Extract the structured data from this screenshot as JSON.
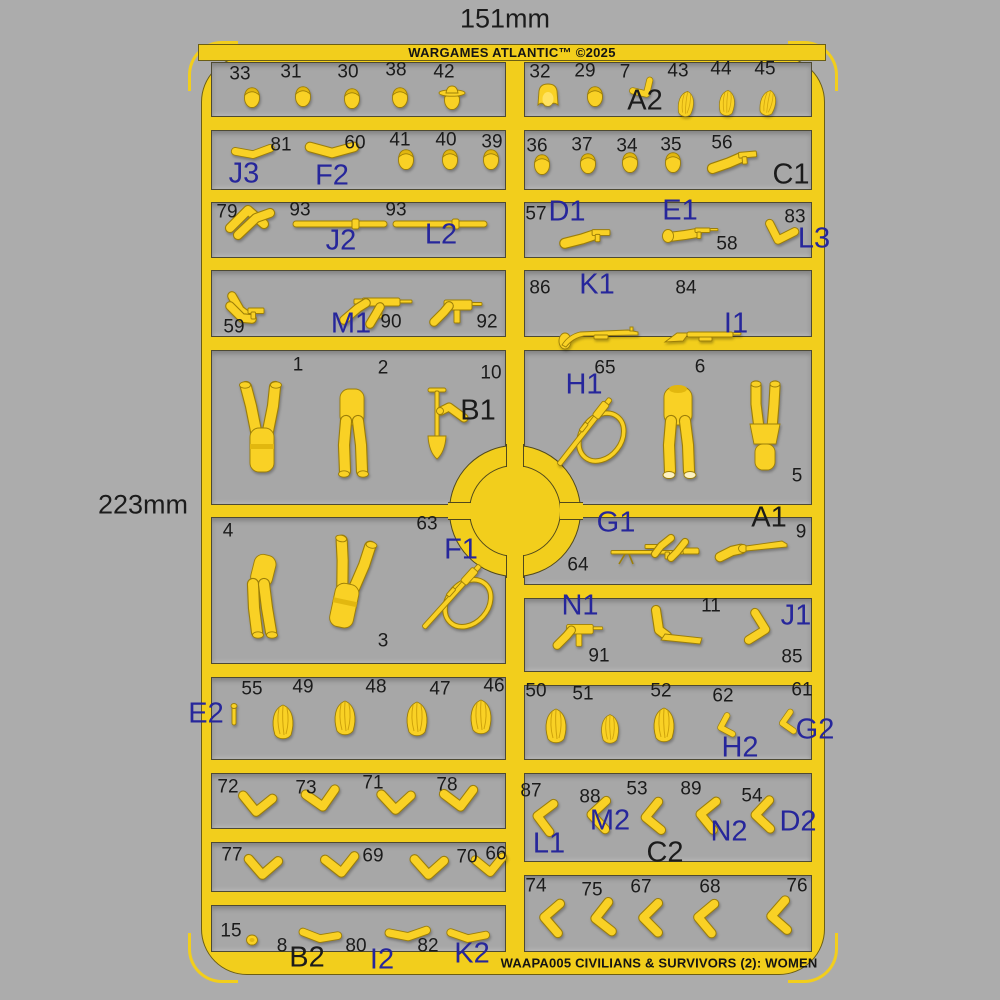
{
  "annotations": {
    "width_label": "151mm",
    "height_label": "223mm",
    "top_title": "WARGAMES ATLANTIC™ ©2025",
    "bottom_title": "WAAPA005 CIVILIANS & SURVIVORS (2): WOMEN"
  },
  "colors": {
    "background": "#acacac",
    "sprue_yellow": "#f2ce1c",
    "compartment_gray": "#a7a7a7",
    "part_yellow": "#f9d125",
    "part_shade": "#9c7e08",
    "code_blue": "#26269b",
    "ink_black": "#1b1b1b"
  },
  "labels": [
    [
      "33",
      "n",
      240,
      74
    ],
    [
      "31",
      "n",
      291,
      72
    ],
    [
      "30",
      "n",
      348,
      72
    ],
    [
      "38",
      "n",
      396,
      70
    ],
    [
      "42",
      "n",
      444,
      72
    ],
    [
      "32",
      "n",
      540,
      72
    ],
    [
      "29",
      "n",
      585,
      71
    ],
    [
      "7",
      "n",
      625,
      72
    ],
    [
      "43",
      "n",
      678,
      71
    ],
    [
      "44",
      "n",
      721,
      69
    ],
    [
      "45",
      "n",
      765,
      69
    ],
    [
      "A2",
      "ck",
      645,
      101
    ],
    [
      "81",
      "n",
      281,
      145
    ],
    [
      "60",
      "n",
      355,
      143
    ],
    [
      "41",
      "n",
      400,
      140
    ],
    [
      "40",
      "n",
      446,
      140
    ],
    [
      "39",
      "n",
      492,
      142
    ],
    [
      "J3",
      "cb",
      244,
      174
    ],
    [
      "F2",
      "cb",
      332,
      176
    ],
    [
      "36",
      "n",
      537,
      146
    ],
    [
      "37",
      "n",
      582,
      145
    ],
    [
      "34",
      "n",
      627,
      146
    ],
    [
      "35",
      "n",
      671,
      145
    ],
    [
      "56",
      "n",
      722,
      143
    ],
    [
      "C1",
      "ck",
      791,
      175
    ],
    [
      "79",
      "n",
      227,
      212
    ],
    [
      "93",
      "n",
      300,
      210
    ],
    [
      "93",
      "n",
      396,
      210
    ],
    [
      "J2",
      "cb",
      341,
      241
    ],
    [
      "L2",
      "cb",
      441,
      235
    ],
    [
      "57",
      "n",
      536,
      214
    ],
    [
      "58",
      "n",
      727,
      244
    ],
    [
      "83",
      "n",
      795,
      217
    ],
    [
      "D1",
      "cb",
      567,
      212
    ],
    [
      "E1",
      "cb",
      680,
      211
    ],
    [
      "L3",
      "cb",
      814,
      239
    ],
    [
      "59",
      "n",
      234,
      327
    ],
    [
      "90",
      "n",
      391,
      322
    ],
    [
      "92",
      "n",
      487,
      322
    ],
    [
      "M1",
      "cb",
      351,
      324
    ],
    [
      "86",
      "n",
      540,
      288
    ],
    [
      "84",
      "n",
      686,
      288
    ],
    [
      "K1",
      "cb",
      597,
      285
    ],
    [
      "I1",
      "cb",
      736,
      324
    ],
    [
      "1",
      "n",
      298,
      365
    ],
    [
      "2",
      "n",
      383,
      368
    ],
    [
      "10",
      "n",
      491,
      373
    ],
    [
      "B1",
      "ck",
      478,
      411
    ],
    [
      "65",
      "n",
      605,
      368
    ],
    [
      "6",
      "n",
      700,
      367
    ],
    [
      "5",
      "n",
      797,
      476
    ],
    [
      "H1",
      "cb",
      584,
      385
    ],
    [
      "4",
      "n",
      228,
      531
    ],
    [
      "63",
      "n",
      427,
      524
    ],
    [
      "3",
      "n",
      383,
      641
    ],
    [
      "F1",
      "cb",
      461,
      550
    ],
    [
      "64",
      "n",
      578,
      565
    ],
    [
      "9",
      "n",
      801,
      532
    ],
    [
      "G1",
      "cb",
      616,
      523
    ],
    [
      "A1",
      "ck",
      769,
      518
    ],
    [
      "91",
      "n",
      599,
      656
    ],
    [
      "11",
      "n",
      711,
      606
    ],
    [
      "85",
      "n",
      792,
      657
    ],
    [
      "N1",
      "cb",
      580,
      606
    ],
    [
      "J1",
      "cb",
      796,
      616
    ],
    [
      "55",
      "n",
      252,
      689
    ],
    [
      "49",
      "n",
      303,
      687
    ],
    [
      "48",
      "n",
      376,
      687
    ],
    [
      "47",
      "n",
      440,
      689
    ],
    [
      "46",
      "n",
      494,
      686
    ],
    [
      "E2",
      "cb",
      206,
      714
    ],
    [
      "50",
      "n",
      536,
      691
    ],
    [
      "51",
      "n",
      583,
      694
    ],
    [
      "52",
      "n",
      661,
      691
    ],
    [
      "62",
      "n",
      723,
      696
    ],
    [
      "61",
      "n",
      802,
      690
    ],
    [
      "H2",
      "cb",
      740,
      748
    ],
    [
      "G2",
      "cb",
      815,
      730
    ],
    [
      "72",
      "n",
      228,
      787
    ],
    [
      "73",
      "n",
      306,
      788
    ],
    [
      "71",
      "n",
      373,
      783
    ],
    [
      "78",
      "n",
      447,
      785
    ],
    [
      "87",
      "n",
      531,
      791
    ],
    [
      "88",
      "n",
      590,
      797
    ],
    [
      "53",
      "n",
      637,
      789
    ],
    [
      "89",
      "n",
      691,
      789
    ],
    [
      "54",
      "n",
      752,
      796
    ],
    [
      "L1",
      "cb",
      549,
      844
    ],
    [
      "M2",
      "cb",
      610,
      821
    ],
    [
      "C2",
      "ck",
      665,
      853
    ],
    [
      "N2",
      "cb",
      729,
      832
    ],
    [
      "D2",
      "cb",
      798,
      822
    ],
    [
      "77",
      "n",
      232,
      855
    ],
    [
      "69",
      "n",
      373,
      856
    ],
    [
      "70",
      "n",
      467,
      857
    ],
    [
      "66",
      "n",
      496,
      854
    ],
    [
      "74",
      "n",
      536,
      886
    ],
    [
      "75",
      "n",
      592,
      890
    ],
    [
      "67",
      "n",
      641,
      887
    ],
    [
      "68",
      "n",
      710,
      887
    ],
    [
      "76",
      "n",
      797,
      886
    ],
    [
      "15",
      "n",
      231,
      931
    ],
    [
      "8",
      "n",
      282,
      946
    ],
    [
      "80",
      "n",
      356,
      946
    ],
    [
      "82",
      "n",
      428,
      946
    ],
    [
      "B2",
      "ck",
      307,
      958
    ],
    [
      "I2",
      "cb",
      382,
      960
    ],
    [
      "K2",
      "cb",
      472,
      954
    ]
  ],
  "parts": [
    [
      "h",
      252,
      97
    ],
    [
      "h",
      303,
      96
    ],
    [
      "h",
      352,
      98
    ],
    [
      "h",
      400,
      97
    ],
    [
      "hhat",
      452,
      99
    ],
    [
      "hhair",
      548,
      97
    ],
    [
      "h",
      595,
      96
    ],
    [
      "ab",
      644,
      91,
      -30,
      0.65
    ],
    [
      "hr",
      686,
      104,
      8,
      0.75
    ],
    [
      "hr",
      727,
      103,
      5,
      0.75
    ],
    [
      "hr",
      768,
      103,
      12,
      0.75
    ],
    [
      "as",
      253,
      153,
      -5,
      0.8
    ],
    [
      "as",
      332,
      151,
      0,
      1
    ],
    [
      "h",
      406,
      159
    ],
    [
      "h",
      450,
      159
    ],
    [
      "h",
      491,
      159
    ],
    [
      "h",
      542,
      164
    ],
    [
      "h",
      588,
      163
    ],
    [
      "h",
      630,
      162
    ],
    [
      "h",
      673,
      162
    ],
    [
      "pg",
      737,
      160,
      -5,
      1.05
    ],
    [
      "ap",
      250,
      220,
      0,
      1
    ],
    [
      "rd",
      340,
      224
    ],
    [
      "rd",
      440,
      224
    ],
    [
      "pg",
      590,
      237,
      0,
      1.05
    ],
    [
      "rv",
      695,
      234
    ],
    [
      "ab",
      779,
      235,
      20,
      0.85
    ],
    [
      "pp",
      248,
      310
    ],
    [
      "sm",
      372,
      308
    ],
    [
      "uz",
      456,
      308
    ],
    [
      "rf",
      600,
      335
    ],
    [
      "sg",
      703,
      336
    ],
    [
      "bu",
      262,
      432
    ],
    [
      "bs",
      352,
      433
    ],
    [
      "sh",
      437,
      420
    ],
    [
      "sr",
      585,
      432,
      -52
    ],
    [
      "bh",
      678,
      433
    ],
    [
      "bk",
      765,
      432
    ],
    [
      "bl",
      258,
      592
    ],
    [
      "bu",
      348,
      588,
      12
    ],
    [
      "sr",
      452,
      597,
      -48
    ],
    [
      "sc",
      655,
      552
    ],
    [
      "bt",
      748,
      549
    ],
    [
      "uz",
      578,
      632,
      0,
      0.95
    ],
    [
      "mc",
      668,
      630
    ],
    [
      "ab",
      760,
      629,
      -75,
      0.9
    ],
    [
      "st",
      234,
      716
    ],
    [
      "hr",
      283,
      722
    ],
    [
      "hr",
      345,
      718
    ],
    [
      "hr",
      417,
      719
    ],
    [
      "hr",
      481,
      717
    ],
    [
      "hr",
      556,
      726
    ],
    [
      "hr",
      610,
      729,
      0,
      0.85
    ],
    [
      "hr",
      664,
      725
    ],
    [
      "ab",
      724,
      726,
      75,
      0.62
    ],
    [
      "ab",
      786,
      722,
      82,
      0.62
    ],
    [
      "ab",
      256,
      806,
      8,
      0.95
    ],
    [
      "ab",
      321,
      801,
      -8,
      0.95
    ],
    [
      "ab",
      395,
      804,
      4,
      0.95
    ],
    [
      "ab",
      459,
      801,
      -6,
      0.95
    ],
    [
      "ab",
      543,
      816,
      100,
      0.92
    ],
    [
      "ab",
      597,
      814,
      94,
      0.92
    ],
    [
      "ab",
      651,
      816,
      86,
      0.92
    ],
    [
      "ab",
      706,
      814,
      98,
      0.92
    ],
    [
      "ab",
      761,
      814,
      90,
      0.92
    ],
    [
      "ab",
      262,
      869,
      6,
      0.95
    ],
    [
      "ab",
      340,
      867,
      -5,
      0.95
    ],
    [
      "ab",
      428,
      869,
      5,
      0.95
    ],
    [
      "ab",
      489,
      867,
      -4,
      0.88
    ],
    [
      "ab",
      550,
      917,
      96,
      0.95
    ],
    [
      "ab",
      601,
      917,
      85,
      0.95
    ],
    [
      "ab",
      649,
      917,
      92,
      0.95
    ],
    [
      "ab",
      704,
      917,
      97,
      0.95
    ],
    [
      "ab",
      777,
      915,
      88,
      0.95
    ],
    [
      "kn",
      252,
      940
    ],
    [
      "as",
      320,
      937,
      6,
      0.8
    ],
    [
      "as",
      408,
      935,
      -4,
      0.85
    ],
    [
      "as",
      468,
      937,
      4,
      0.8
    ]
  ]
}
